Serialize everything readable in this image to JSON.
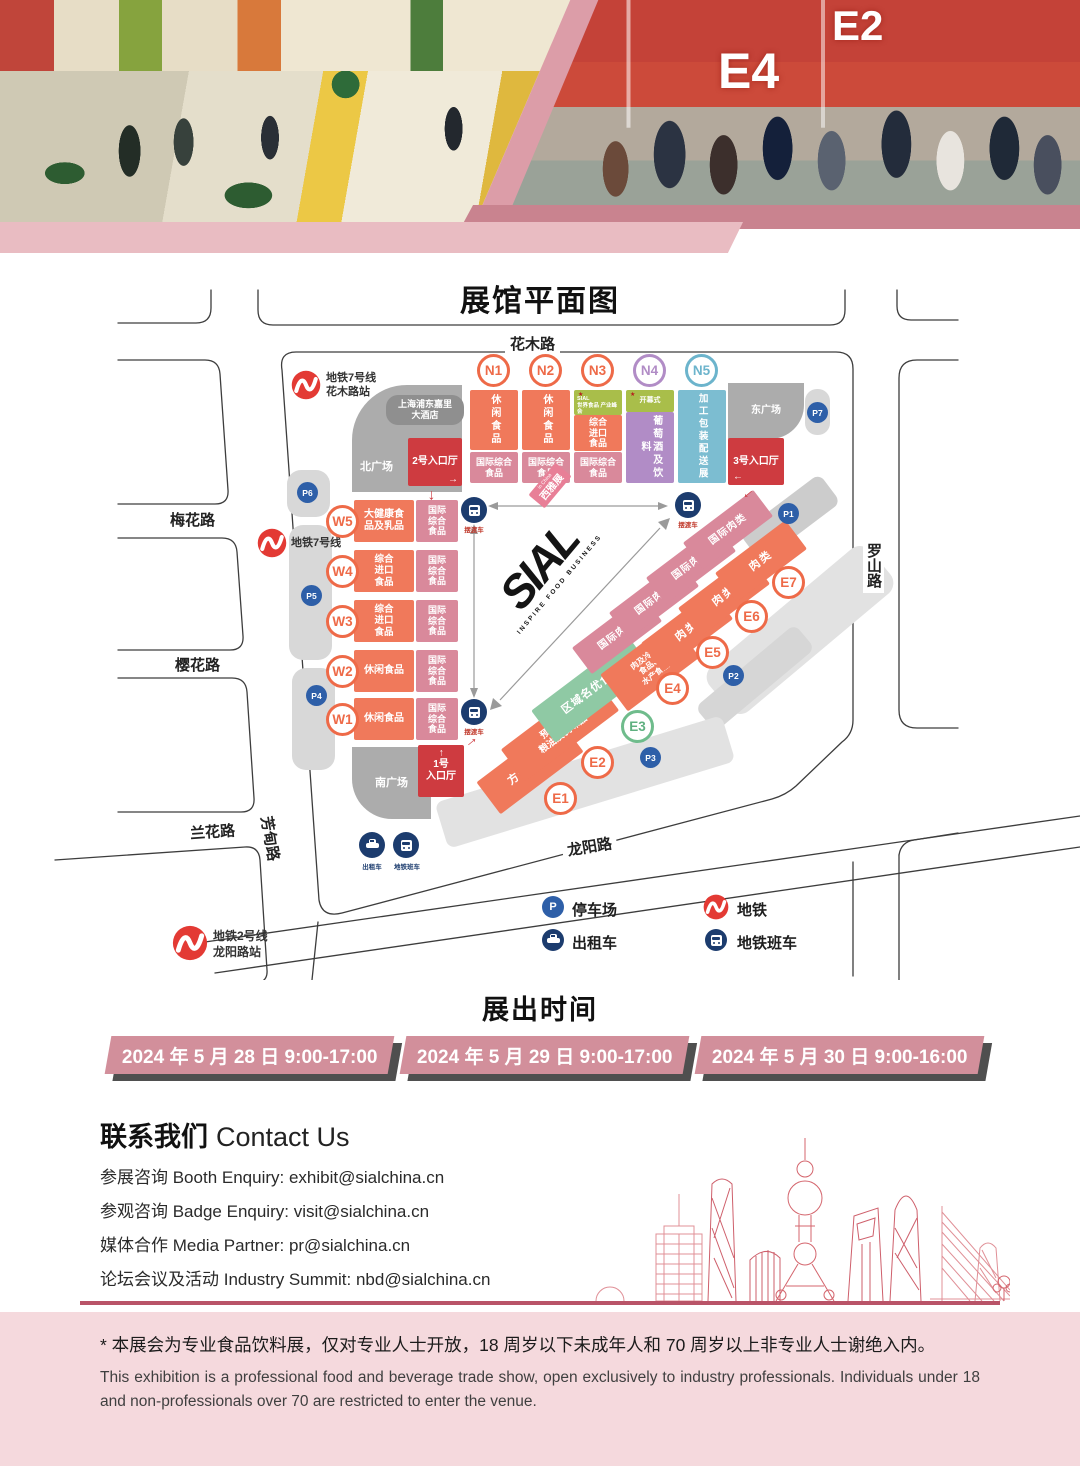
{
  "header": {
    "banners": [
      "E4",
      "E2"
    ]
  },
  "map": {
    "title": "展馆平面图",
    "streets": {
      "north": "花木路",
      "west_1": "梅花路",
      "west_2": "樱花路",
      "west_3": "兰花路",
      "west_v": "芳甸路",
      "east": "罗山路",
      "south": "龙阳路"
    },
    "metro": {
      "line7_station": {
        "line": "地铁7号线",
        "station": "花木路站"
      },
      "line7": {
        "line": "地铁7号线"
      },
      "line2_station": {
        "line": "地铁2号线",
        "station": "龙阳路站"
      }
    },
    "plazas": {
      "north": "北广场",
      "east": "东广场",
      "south": "南广场",
      "hotel": "上海浦东嘉里\n大酒店"
    },
    "entrances": {
      "no1": "1号\n入口厅",
      "no2": "2号入口厅",
      "no3": "3号入口厅"
    },
    "halls_n": [
      {
        "id": "N1",
        "main": "休闲食品",
        "sub": "国际综合\n食品"
      },
      {
        "id": "N2",
        "main": "休闲食品",
        "sub": "国际综合\n食品"
      },
      {
        "id": "N3",
        "tag": "SIAL\n世界食品 产业峰会",
        "main": "综合\n进口\n食品",
        "sub": "国际综合\n食品"
      },
      {
        "id": "N4",
        "tag": "开幕式",
        "main": "葡萄酒及饮料"
      },
      {
        "id": "N5",
        "main": "加工包装配送展"
      }
    ],
    "halls_w": [
      {
        "id": "W5",
        "main": "大健康食\n品及乳品",
        "sub": "国际\n综合\n食品"
      },
      {
        "id": "W4",
        "main": "综合\n进口\n食品",
        "sub": "国际\n综合\n食品"
      },
      {
        "id": "W3",
        "main": "综合\n进口\n食品",
        "sub": "国际\n综合\n食品"
      },
      {
        "id": "W2",
        "main": "休闲食品",
        "sub": "国际\n综合\n食品"
      },
      {
        "id": "W1",
        "main": "休闲食品",
        "sub": "国际\n综合\n食品"
      }
    ],
    "halls_e": [
      {
        "id": "E1",
        "main": "方便食品"
      },
      {
        "id": "E2",
        "main": "预制菜、\n粮油及调味品"
      },
      {
        "id": "E3",
        "main": "区域名优食品"
      },
      {
        "id": "E4",
        "intl": "国际肉类",
        "main": "肉及冷冻\n食品、\n水产食品"
      },
      {
        "id": "E5",
        "intl": "国际肉类",
        "main": "肉类"
      },
      {
        "id": "E6",
        "intl": "国际肉类",
        "main": "肉类"
      },
      {
        "id": "E7",
        "intl": "国际肉类",
        "main": "肉类"
      }
    ],
    "parkings": [
      "P1",
      "P2",
      "P3",
      "P4",
      "P5",
      "P6",
      "P7"
    ],
    "parking_symbol": "P",
    "transit": {
      "shuttle": "摆渡车",
      "taxi": "出租车",
      "metro_bus": "地铁班车"
    },
    "legend": [
      {
        "icon": "parking",
        "label": "停车场"
      },
      {
        "icon": "metro",
        "label": "地铁"
      },
      {
        "icon": "taxi",
        "label": "出租车"
      },
      {
        "icon": "metro-bus",
        "label": "地铁班车"
      }
    ],
    "center_logo": {
      "name": "SIAL",
      "tagline": "INSPIRE FOOD BUSINESS",
      "badge": "西雅展",
      "badge_note": "in China"
    }
  },
  "schedule": {
    "title": "展出时间",
    "dates": [
      "2024 年 5 月 28 日  9:00-17:00",
      "2024 年 5 月 29 日  9:00-17:00",
      "2024 年 5 月 30 日  9:00-16:00"
    ]
  },
  "contact": {
    "title_zh": "联系我们",
    "title_en": "Contact Us",
    "lines": [
      "参展咨询 Booth Enquiry: exhibit@sialchina.cn",
      "参观咨询 Badge Enquiry: visit@sialchina.cn",
      "媒体合作 Media Partner: pr@sialchina.cn",
      "论坛会议及活动 Industry Summit: nbd@sialchina.cn"
    ]
  },
  "disclaimer": {
    "zh": "* 本展会为专业食品饮料展，仅对专业人士开放，18 周岁以下未成年人和 70 周岁以上非专业人士谢绝入内。",
    "en": "This exhibition is a professional food and beverage trade show, open exclusively to industry professionals. Individuals under 18 and non-professionals over 70 are restricted to enter the venue."
  },
  "colors": {
    "hall_orange": "#F0795B",
    "hall_pink": "#D9899B",
    "hall_purple": "#B18CC6",
    "hall_teal": "#7CBDD1",
    "hall_green": "#8FC9A4",
    "tag_olive": "#A9BE4A",
    "entrance_red": "#CE3B40",
    "plaza_gray": "#ACACAC",
    "navy": "#1C3C6E",
    "parking_blue": "#2E5FA8",
    "metro_red": "#E33A34",
    "banner_pink": "#D28F9B",
    "footer_pink": "#F5D9DD",
    "divider": "#B95468"
  }
}
